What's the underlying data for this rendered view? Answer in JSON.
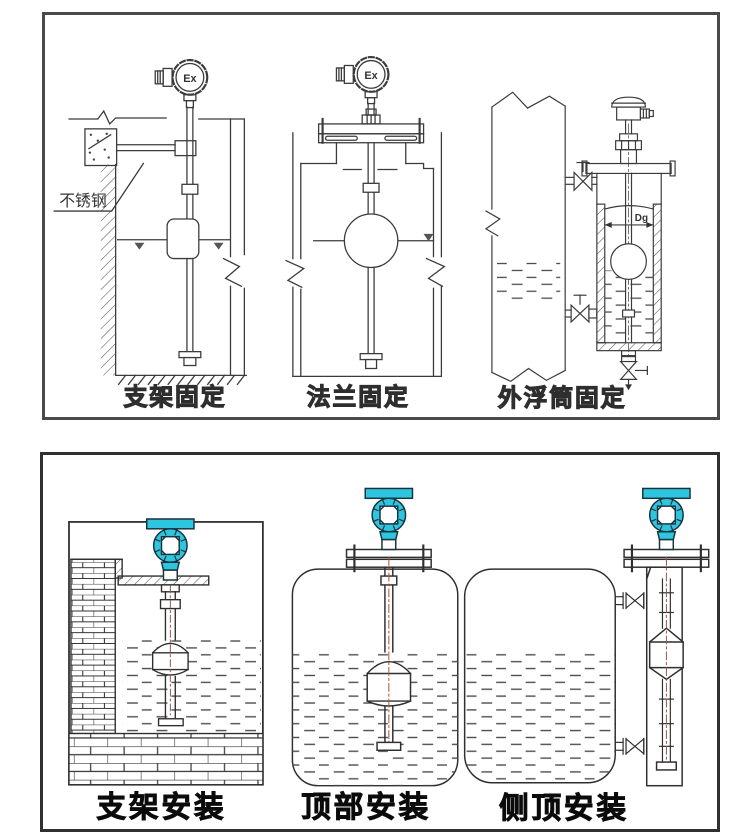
{
  "panel_top": {
    "captions": {
      "bracket": "支架固定",
      "flange": "法兰固定",
      "external_float_chamber": "外浮筒固定"
    },
    "labels": {
      "stainless_steel": "不锈钢",
      "ex": "Ex",
      "diameter": "Dg"
    }
  },
  "panel_bottom": {
    "captions": {
      "bracket": "支架安装",
      "top_mount": "顶部安装",
      "side_top_mount": "侧顶安装"
    }
  },
  "colors": {
    "background": "#ffffff",
    "line": "#3b3b3b",
    "panel_border": "#4a4a4a",
    "transmitter_cyan": "#2ec6df",
    "centerline": "#a2543f"
  }
}
